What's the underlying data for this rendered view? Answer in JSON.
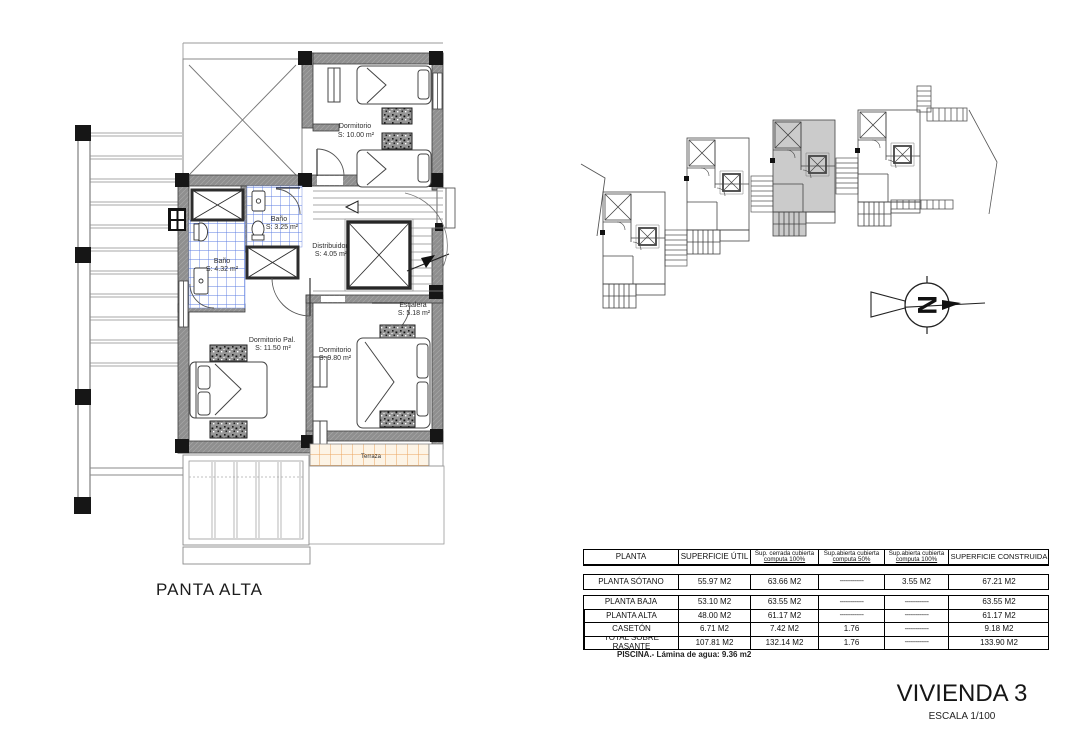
{
  "floor_plan": {
    "caption": "PANTA ALTA",
    "rooms": [
      {
        "label": "Dormitorio",
        "area": "S: 10.00 m²"
      },
      {
        "label": "Baño",
        "area": "S: 3.25 m²"
      },
      {
        "label": "Baño",
        "area": "S: 4.32 m²"
      },
      {
        "label": "Distribuidor",
        "area": "S: 4.05 m²"
      },
      {
        "label": "Escalera",
        "area": "S: 5.18 m²"
      },
      {
        "label": "Dormitorio Pal.",
        "area": "S: 11.50 m²"
      },
      {
        "label": "Dormitorio",
        "area": "S: 9.80 m²"
      },
      {
        "label": "Terraza",
        "area": ""
      }
    ],
    "colors": {
      "wall": "#8f8f8f",
      "column": "#161616",
      "bath_tile": "#5c7de2",
      "terrace_tile": "#eba55e"
    }
  },
  "site_plan": {
    "highlighted_unit": "Vivienda 3",
    "highlight_color": "#cbcbcb",
    "north_label": "N"
  },
  "areas_table": {
    "headers": [
      {
        "l1": "PLANTA",
        "l2": ""
      },
      {
        "l1": "SUPERFICIE ÚTIL",
        "l2": ""
      },
      {
        "l1": "Sup. cerrada cubierta",
        "l2": "computa 100%"
      },
      {
        "l1": "Sup.abierta cubierta",
        "l2": "computa 50%"
      },
      {
        "l1": "Sup.abierta cubierta",
        "l2": "computa 100%"
      },
      {
        "l1": "SUPERFICIE CONSTRUIDA",
        "l2": ""
      }
    ],
    "rows": [
      {
        "name": "PLANTA SÓTANO",
        "util": "55.97 M2",
        "cerrada": "63.66 M2",
        "abierta50": "-------------",
        "abierta100": "3.55 M2",
        "construida": "67.21 M2"
      },
      {
        "name": "PLANTA BAJA",
        "util": "53.10 M2",
        "cerrada": "63.55 M2",
        "abierta50": "-------------",
        "abierta100": "-------------",
        "construida": "63.55 M2"
      },
      {
        "name": "PLANTA ALTA",
        "util": "48.00 M2",
        "cerrada": "61.17 M2",
        "abierta50": "-------------",
        "abierta100": "-------------",
        "construida": "61.17 M2"
      },
      {
        "name": "CASETÓN",
        "util": "6.71 M2",
        "cerrada": "7.42 M2",
        "abierta50": "1.76",
        "abierta100": "-------------",
        "construida": "9.18 M2"
      },
      {
        "name": "TOTAL SOBRE RASANTE",
        "util": "107.81 M2",
        "cerrada": "132.14 M2",
        "abierta50": "1.76",
        "abierta100": "-------------",
        "construida": "133.90 M2"
      }
    ]
  },
  "note": "PISCINA.- Lámina de agua: 9.36 m2",
  "title_block": {
    "title": "VIVIENDA 3",
    "scale": "ESCALA 1/100"
  }
}
